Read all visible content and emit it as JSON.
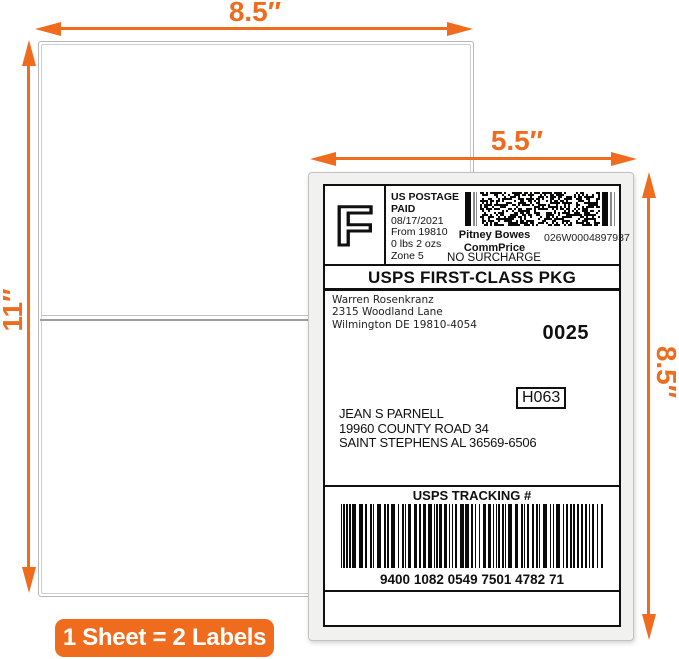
{
  "colors": {
    "accent": "#EF6C1E"
  },
  "annotations": {
    "sheet_width": "8.5″",
    "sheet_height": "11″",
    "label_width": "5.5″",
    "label_height": "8.5″",
    "badge_text": "1 Sheet = 2 Labels"
  },
  "label": {
    "indicia_letter": "F",
    "postage": [
      "US POSTAGE PAID",
      "08/17/2021",
      "From 19810",
      "0 lbs 2 ozs",
      "Zone 5"
    ],
    "meter": {
      "vendor_line1": "Pitney Bowes",
      "vendor_line2": "CommPrice",
      "meter_id": "026W0004897937",
      "surcharge_note": "NO SURCHARGE"
    },
    "service": "USPS FIRST-CLASS PKG",
    "sender": [
      "Warren Rosenkranz",
      "2315 Woodland Lane",
      "Wilmington DE 19810-4054"
    ],
    "batch_number": "0025",
    "routing_code": "H063",
    "recipient": [
      "JEAN S PARNELL",
      "19960 COUNTY ROAD 34",
      "SAINT STEPHENS AL 36569-6506"
    ],
    "tracking": {
      "title": "USPS TRACKING #",
      "number": "9400 1082 0549 7501 4782 71"
    }
  }
}
